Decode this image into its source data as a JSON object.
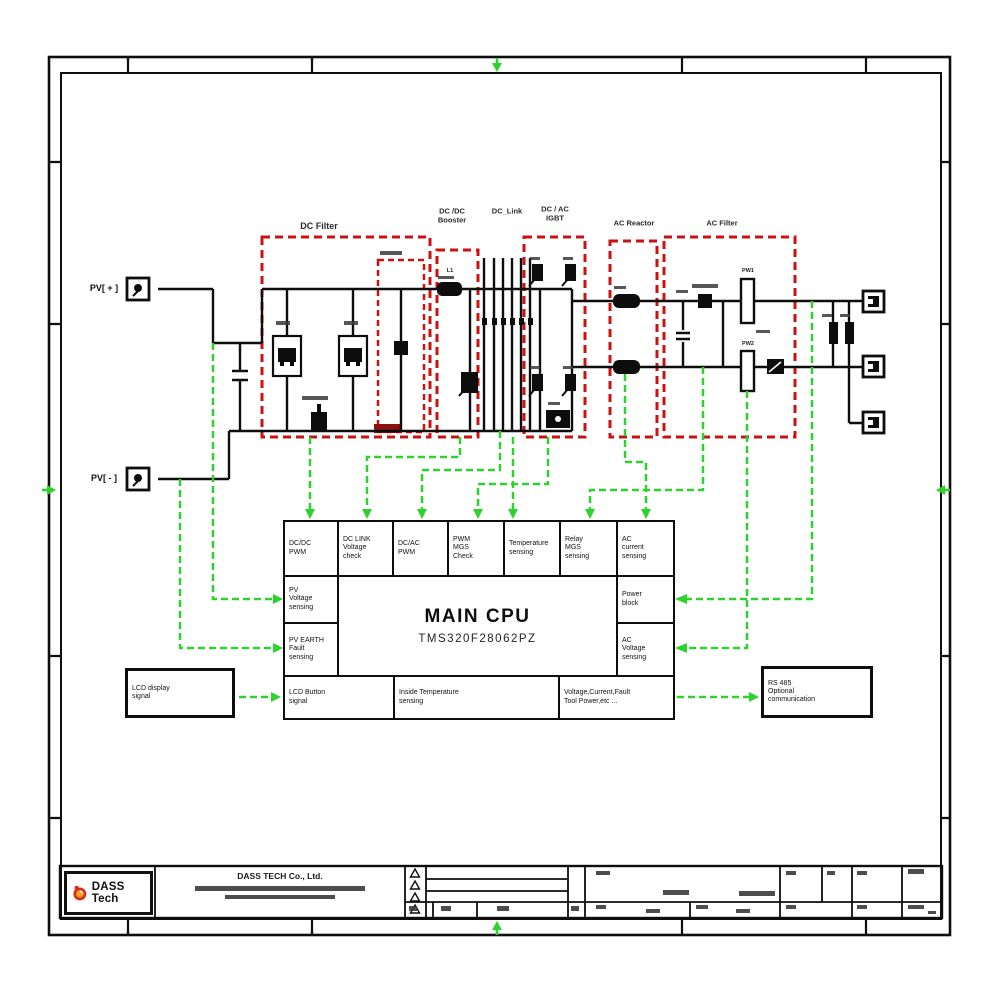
{
  "terminals": {
    "pv_plus": "PV[ + ]",
    "pv_minus": "PV[ - ]"
  },
  "sections": {
    "dc_filter": "DC Filter",
    "dcdc_booster": "DC /DC\nBooster",
    "dc_link": "DC_Link",
    "dcac_igbt": "DC / AC\nIGBT",
    "ac_reactor": "AC Reactor",
    "ac_filter": "AC Filter"
  },
  "components": {
    "l1": "L1",
    "pw1": "PW1",
    "pw2": "PW2"
  },
  "cpu": {
    "title": "MAIN CPU",
    "chip": "TMS320F28062PZ",
    "top_row": [
      "DC/DC\nPWM",
      "DC LINK\nVoltage\ncheck",
      "DC/AC\nPWM",
      "PWM\nMGS\nCheck",
      "Temperature\nsensing",
      "Relay\nMGS\nsensing",
      "AC\ncurrent\nsensing"
    ],
    "left_col": [
      "PV\nVoltage\nsensing",
      "PV EARTH\nFault\nsensing"
    ],
    "right_col": [
      "Power\nblock",
      "AC\nVoltage\nsensing"
    ],
    "bottom_row": [
      "LCD Button\nsignal",
      "Inside Temperature\nsensing",
      "Voltage,Current,Fault\nTool Power,etc ..."
    ]
  },
  "external": {
    "lcd": "LCD display\nsignal",
    "rs485": "RS 485\nOptional\ncommunication"
  },
  "titleblock": {
    "logo": "DASS Tech",
    "company": "DASS TECH Co., Ltd."
  },
  "colors": {
    "line": "#101010",
    "red": "#cc1111",
    "green": "#2fd12f",
    "logo_red": "#d6301d",
    "logo_orange": "#f5a323"
  }
}
